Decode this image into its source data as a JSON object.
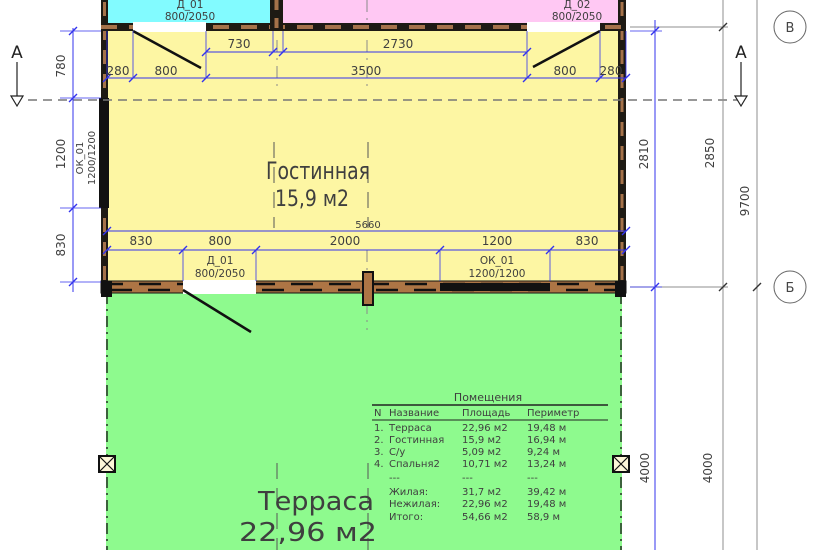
{
  "drawing": {
    "rooms": {
      "living": {
        "name": "Гостинная",
        "area": "15,9 м2"
      },
      "terrace": {
        "name": "Терраса",
        "area": "22,96 м2"
      }
    },
    "openings": {
      "door_top_left": {
        "code": "Д_01",
        "size": "800/2050"
      },
      "door_top_right": {
        "code": "Д_02",
        "size": "800/2050"
      },
      "door_bottom": {
        "code": "Д_01",
        "size": "800/2050"
      },
      "window_bottom": {
        "code": "ОК_01",
        "size": "1200/1200"
      },
      "window_left": {
        "code": "ОК_01",
        "size": "1200/1200"
      }
    },
    "dims": {
      "top_inner": [
        "730",
        "2730"
      ],
      "top_outer": [
        "280",
        "800",
        "3500",
        "800",
        "280"
      ],
      "width_total": "5660",
      "bottom": [
        "830",
        "800",
        "2000",
        "1200",
        "830"
      ],
      "left": [
        "780",
        "1200",
        "830"
      ],
      "right": [
        "2810",
        "2850",
        "9700"
      ],
      "terrace_right": [
        "4000",
        "4000"
      ]
    },
    "markers": {
      "section_left": "А",
      "section_right": "А",
      "grid_top": "В",
      "grid_bottom": "Б"
    }
  },
  "table": {
    "title": "Помещения",
    "headers": [
      "N",
      "Название",
      "Площадь",
      "Периметр"
    ],
    "rows": [
      [
        "1.",
        "Терраса",
        "22,96 м2",
        "19,48 м"
      ],
      [
        "2.",
        "Гостинная",
        "15,9 м2",
        "16,94 м"
      ],
      [
        "3.",
        "С/у",
        "5,09 м2",
        "9,24 м"
      ],
      [
        "4.",
        "Спальня2",
        "10,71 м2",
        "13,24 м"
      ]
    ],
    "separator": [
      "---",
      "---",
      "---"
    ],
    "totals": [
      [
        "Жилая:",
        "31,7 м2",
        "39,42 м"
      ],
      [
        "Нежилая:",
        "22,96 м2",
        "19,48 м"
      ],
      [
        "Итого:",
        "54,66 м2",
        "58,9 м"
      ]
    ]
  },
  "colors": {
    "room_cyan": "#82fbff",
    "room_pink": "#ffc8f3",
    "room_yellow": "#fdf6a3",
    "room_green": "#8efa8e",
    "dim_blue": "#3333ee",
    "dim_gray": "#777777",
    "wall_dark": "#1e1a14",
    "wall_brown": "#ad7545"
  }
}
